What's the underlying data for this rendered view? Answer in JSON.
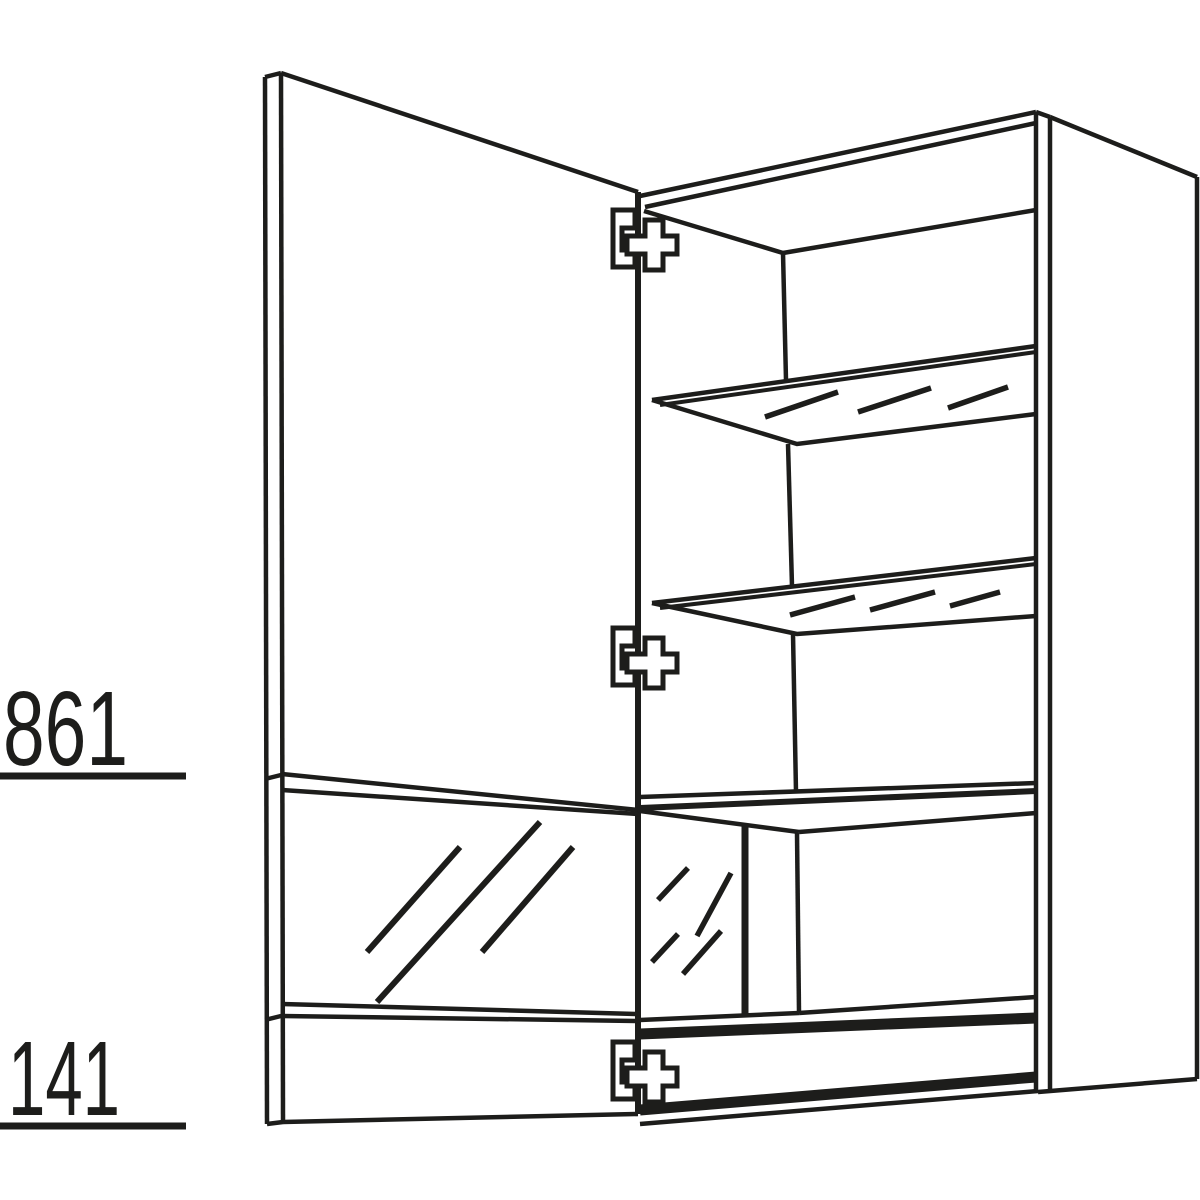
{
  "canvas": {
    "background": "#ffffff",
    "ink_color": "#1d1d1b",
    "width": 1200,
    "height": 1200
  },
  "diagram": {
    "kind": "furniture-technical-drawing",
    "subject": "Wall cabinet shown in perspective with open hinged door, two glass shelves with hatch marks, lower glass-front compartment and bottom panel",
    "dimension_labels": {
      "upper": {
        "value": "861"
      },
      "lower": {
        "value": "141"
      }
    },
    "parts": [
      "open-door",
      "door-glass-insert",
      "hinge-top",
      "hinge-middle",
      "hinge-bottom",
      "glass-shelf-upper",
      "glass-shelf-lower",
      "fixed-middle-shelf",
      "interior-glass-panel",
      "carcass-right-side",
      "bottom-panel"
    ]
  }
}
